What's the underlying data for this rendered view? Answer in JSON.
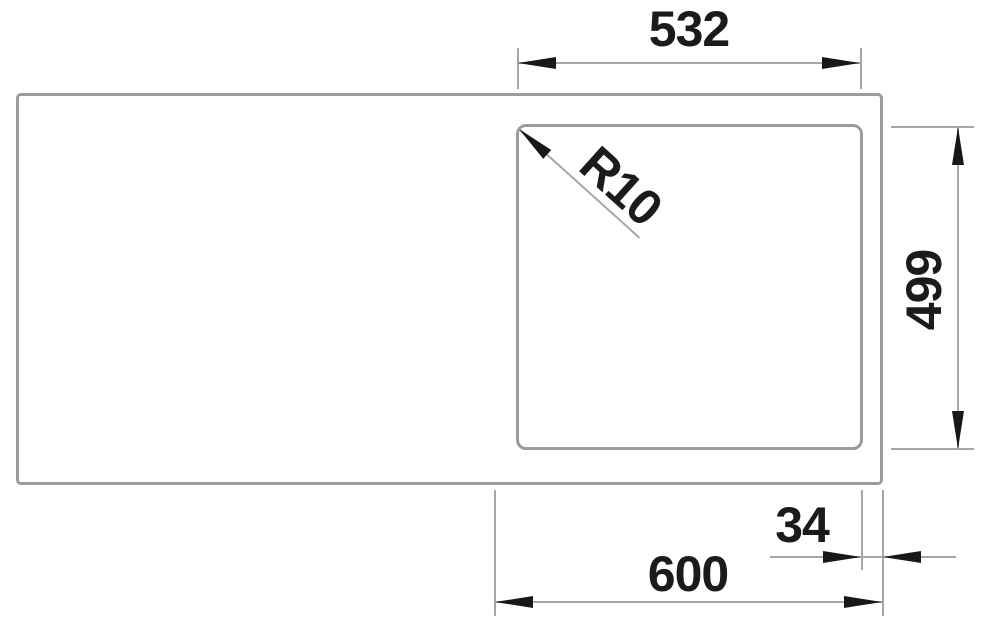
{
  "drawing": {
    "type": "technical-dimension-drawing",
    "subject": "sink-top-view",
    "labels": {
      "basin_width": "532",
      "basin_depth": "499",
      "edge_offset": "34",
      "cabinet_width": "600",
      "corner_radius": "R10"
    },
    "colors": {
      "background": "#ffffff",
      "outline": "#9c9c9c",
      "dimension_line": "#a6a6a6",
      "arrow": "#181818",
      "text": "#1b1b1b"
    }
  }
}
